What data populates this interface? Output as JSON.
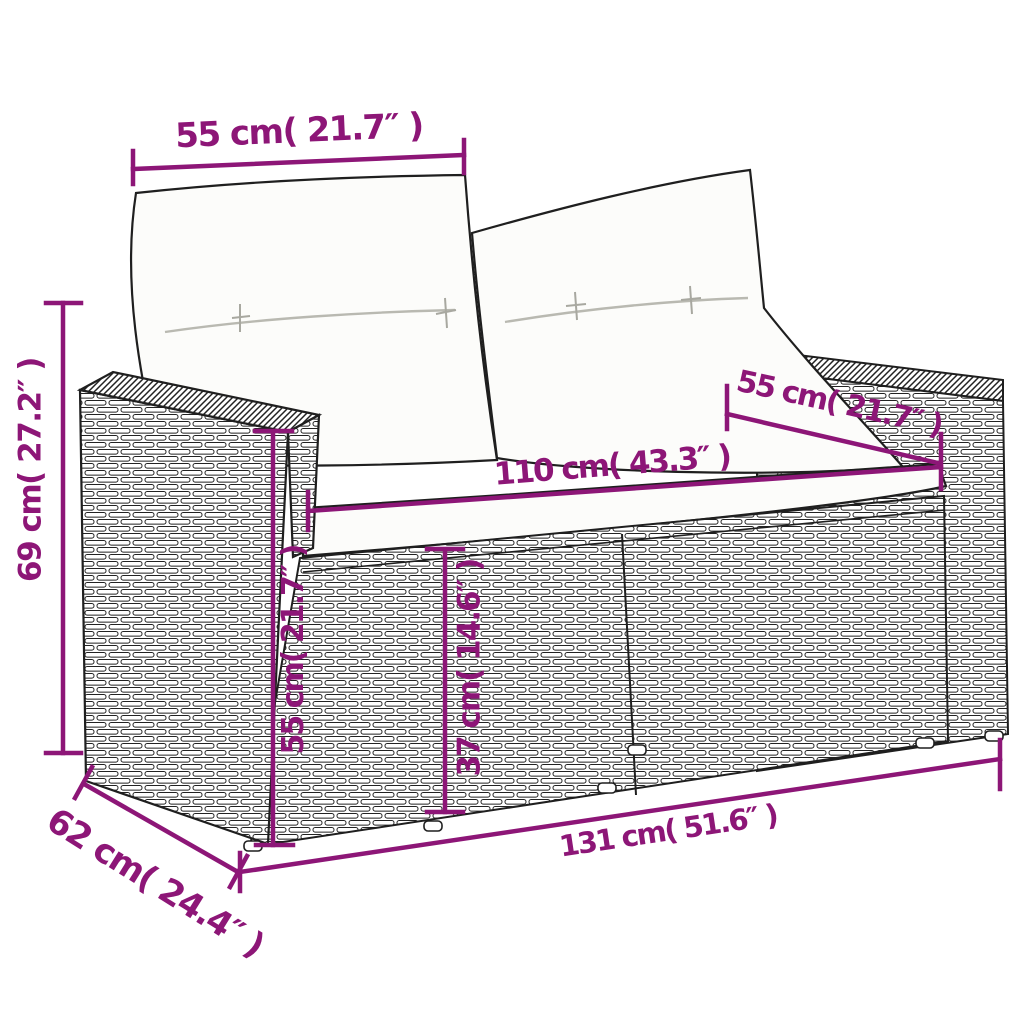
{
  "diagram": {
    "kind": "product-dimension-diagram",
    "depicted_item": "2-seater rattan garden sofa with back and seat cushions",
    "accent_color": "#8D1677",
    "line_art_color": "#1f1f1f",
    "cushion_color": "#fcfcfa",
    "dimensions": {
      "back_width": "55 cm( 21.7″ )",
      "overall_height": "69 cm( 27.2″ )",
      "armrest_depth": "55 cm( 21.7″ )",
      "seat_width": "110 cm( 43.3″ )",
      "armrest_height": "55 cm( 21.7″ )",
      "seat_height": "37 cm( 14.6″ )",
      "overall_width": "131 cm( 51.6″ )",
      "overall_depth": "62 cm( 24.4″ )"
    }
  }
}
